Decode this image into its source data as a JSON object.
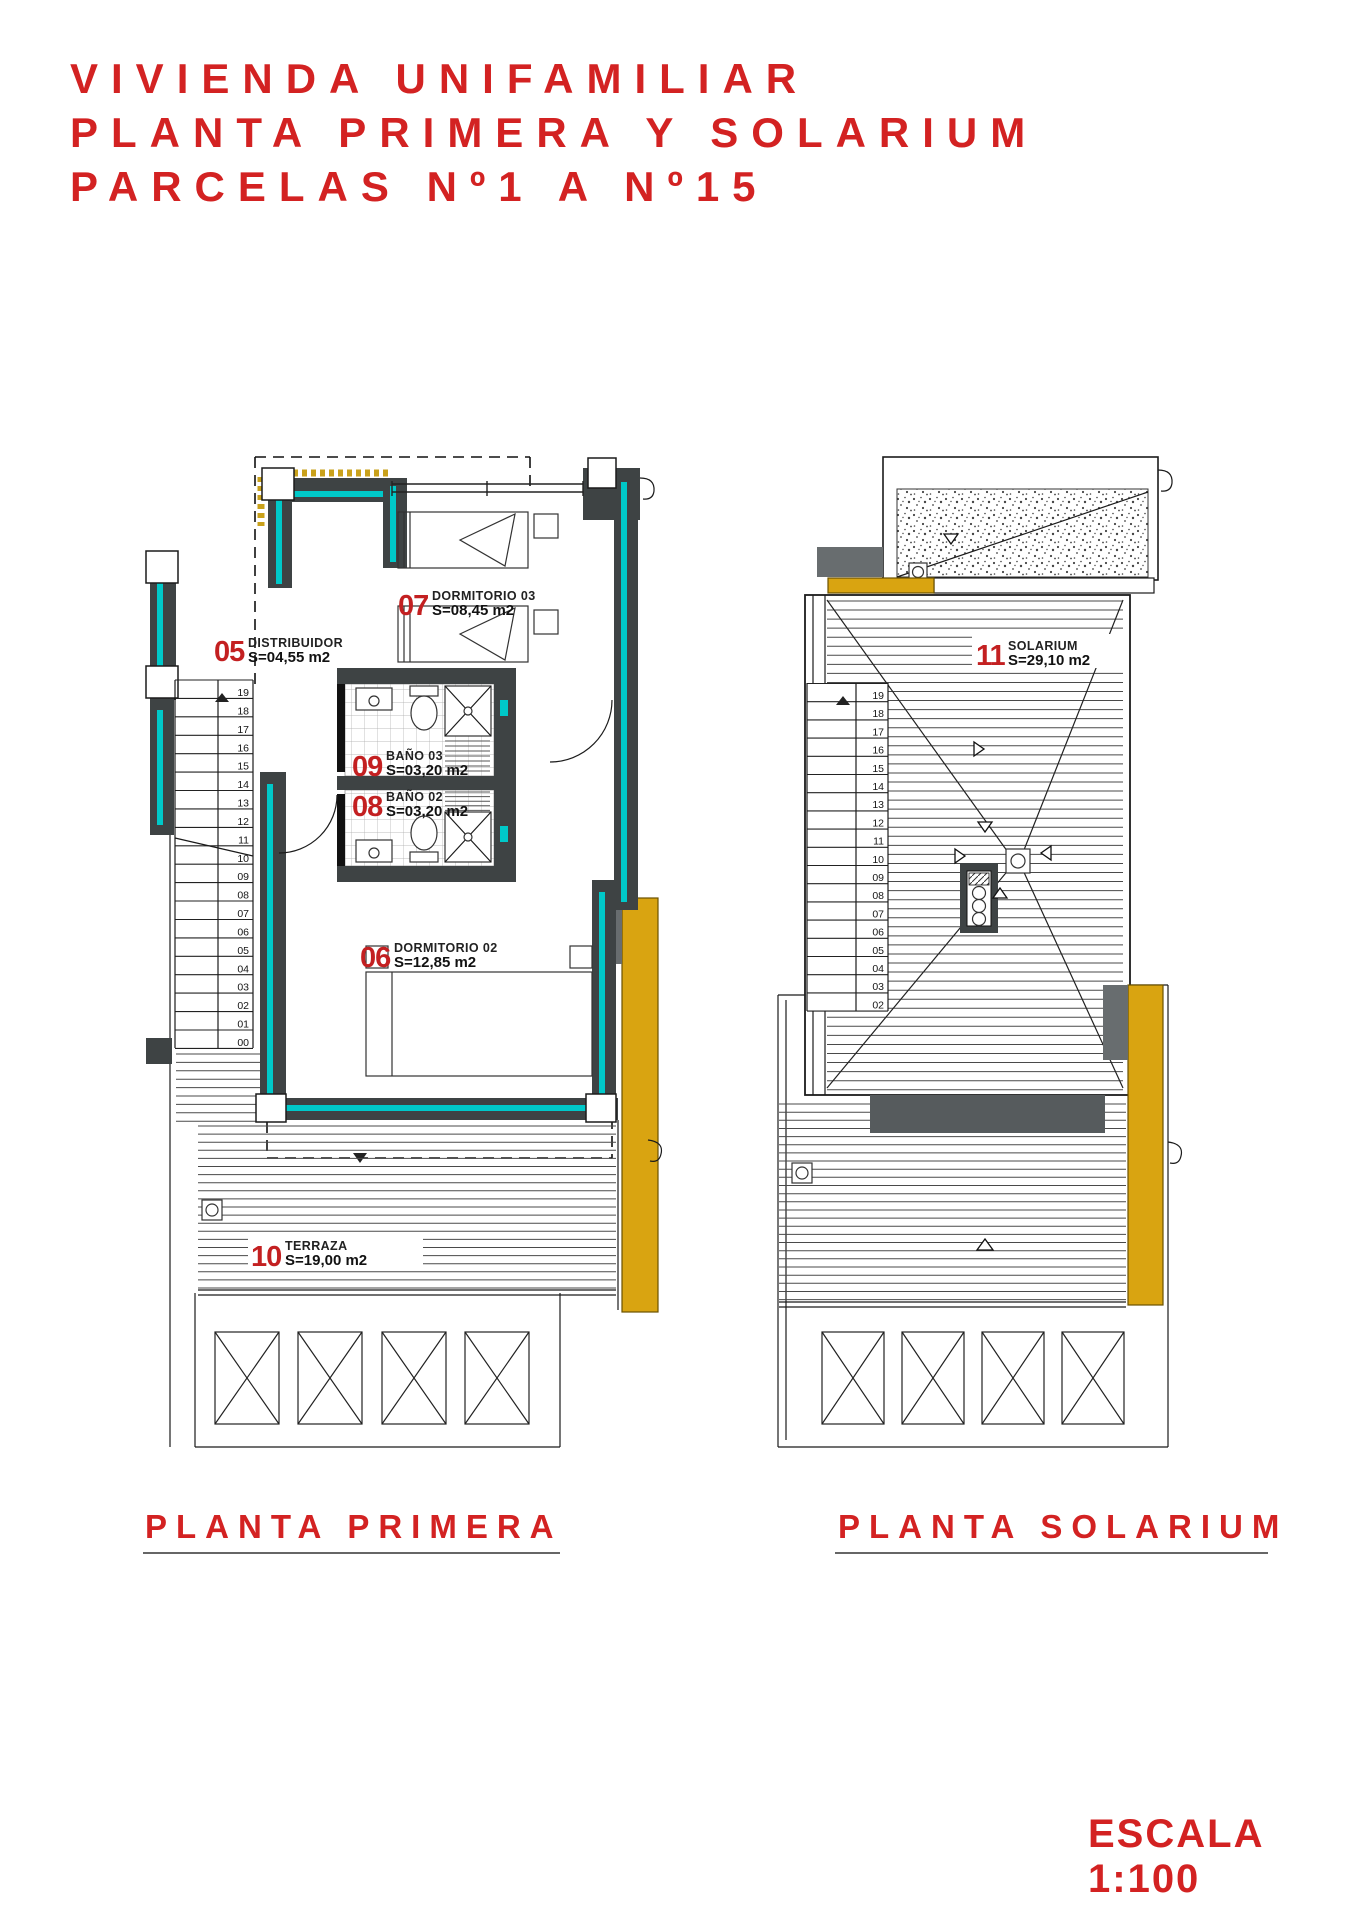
{
  "title": {
    "line1": "VIVIENDA UNIFAMILIAR",
    "line2": "PLANTA PRIMERA Y SOLARIUM",
    "line3": "PARCELAS Nº1 A Nº15"
  },
  "scale": {
    "label": "ESCALA 1:100"
  },
  "colors": {
    "accent_red": "#d32222",
    "wall_dark": "#3e4344",
    "insulation_teal": "#00c9c9",
    "wood_yellow": "#d9a411",
    "concrete_gray": "#686d6f"
  },
  "plan_primera": {
    "caption": "PLANTA PRIMERA",
    "rooms": {
      "distribuidor": {
        "num": "05",
        "name": "DISTRIBUIDOR",
        "area": "S=04,55 m2"
      },
      "dormitorio3": {
        "num": "07",
        "name": "DORMITORIO 03",
        "area": "S=08,45 m2"
      },
      "bano3": {
        "num": "09",
        "name": "BAÑO 03",
        "area": "S=03,20 m2"
      },
      "bano2": {
        "num": "08",
        "name": "BAÑO 02",
        "area": "S=03,20 m2"
      },
      "dormitorio2": {
        "num": "06",
        "name": "DORMITORIO 02",
        "area": "S=12,85 m2"
      },
      "terraza": {
        "num": "10",
        "name": "TERRAZA",
        "area": "S=19,00 m2"
      }
    },
    "stair_steps": [
      "19",
      "18",
      "17",
      "16",
      "15",
      "14",
      "13",
      "12",
      "11",
      "10",
      "09",
      "08",
      "07",
      "06",
      "05",
      "04",
      "03",
      "02",
      "01",
      "00"
    ]
  },
  "plan_solarium": {
    "caption": "PLANTA SOLARIUM",
    "rooms": {
      "solarium": {
        "num": "11",
        "name": "SOLARIUM",
        "area": "S=29,10 m2"
      }
    },
    "stair_steps": [
      "19",
      "18",
      "17",
      "16",
      "15",
      "14",
      "13",
      "12",
      "11",
      "10",
      "09",
      "08",
      "07",
      "06",
      "05",
      "04",
      "03",
      "02"
    ]
  }
}
